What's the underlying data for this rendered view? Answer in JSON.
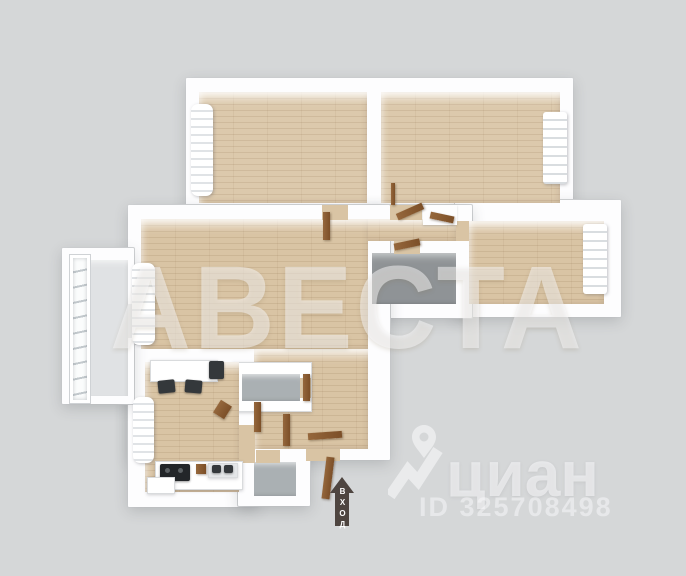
{
  "watermarks": {
    "agency": "АВЕСТА",
    "portal": "циан",
    "listing_id": "ID 325708498"
  },
  "entrance": {
    "label": "ВХОД"
  },
  "palette": {
    "background": "#d5d7d8",
    "wall": "#fdfdfe",
    "wood_floor": "#d9c4a4",
    "bathroom_floor": "#8f9396",
    "utility_floor": "#aab0b3",
    "balcony_floor": "#e0e2e4",
    "door": "#8a5c36",
    "entrance_arrow": "#4e4540",
    "watermark": "rgba(255,255,255,0.55)"
  }
}
